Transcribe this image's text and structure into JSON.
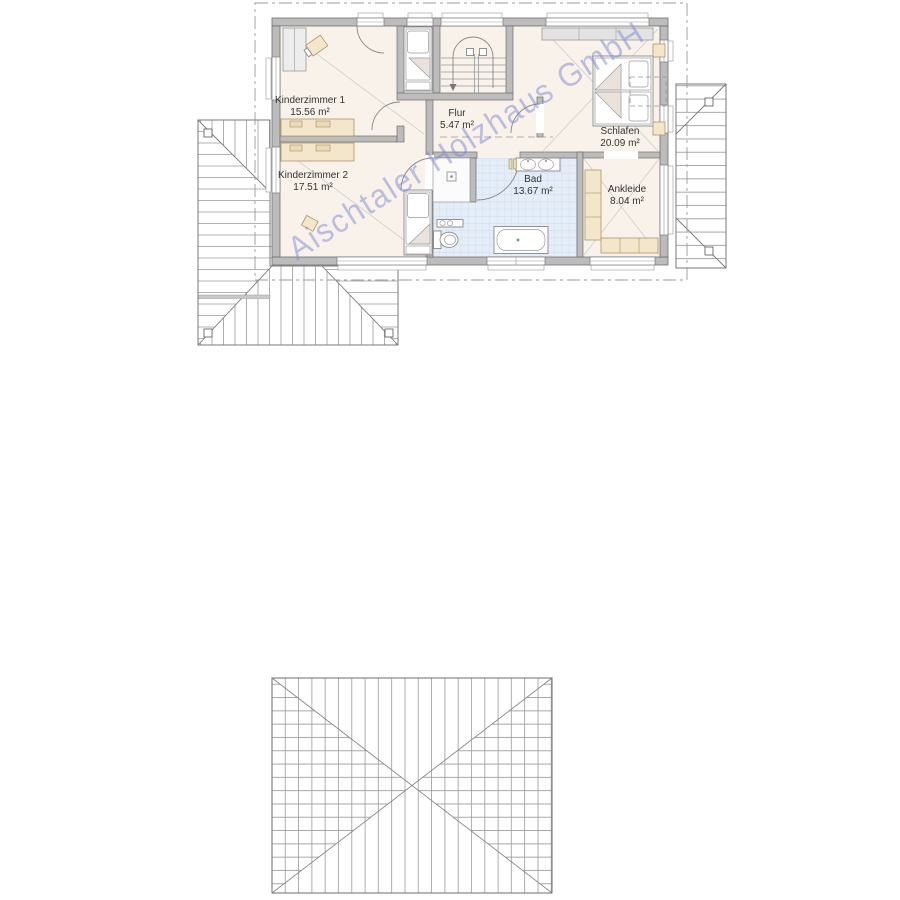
{
  "watermark": "Aischtaler Holzhaus GmbH",
  "floor_plan": {
    "rooms": [
      {
        "id": "kinderzimmer-1",
        "name": "Kinderzimmer 1",
        "area": "15.56 m²"
      },
      {
        "id": "kinderzimmer-2",
        "name": "Kinderzimmer 2",
        "area": "17.51 m²"
      },
      {
        "id": "flur",
        "name": "Flur",
        "area": "5.47 m²"
      },
      {
        "id": "schlafen",
        "name": "Schlafen",
        "area": "20.09 m²"
      },
      {
        "id": "bad",
        "name": "Bad",
        "area": "13.67 m²"
      },
      {
        "id": "ankleide",
        "name": "Ankleide",
        "area": "8.04 m²"
      }
    ]
  },
  "colors": {
    "wall": "#bcbcbc",
    "wall_outline": "#6e6e6e",
    "floor": "#f8f2ea",
    "bath_tile": "#e4edf8",
    "bath_tile_line": "#c6d5ea",
    "furniture_wood": "#f4e6ca",
    "hatch_line": "#9a9a9a",
    "watermark_text": "#7f8ad6",
    "label_text": "#333333"
  }
}
